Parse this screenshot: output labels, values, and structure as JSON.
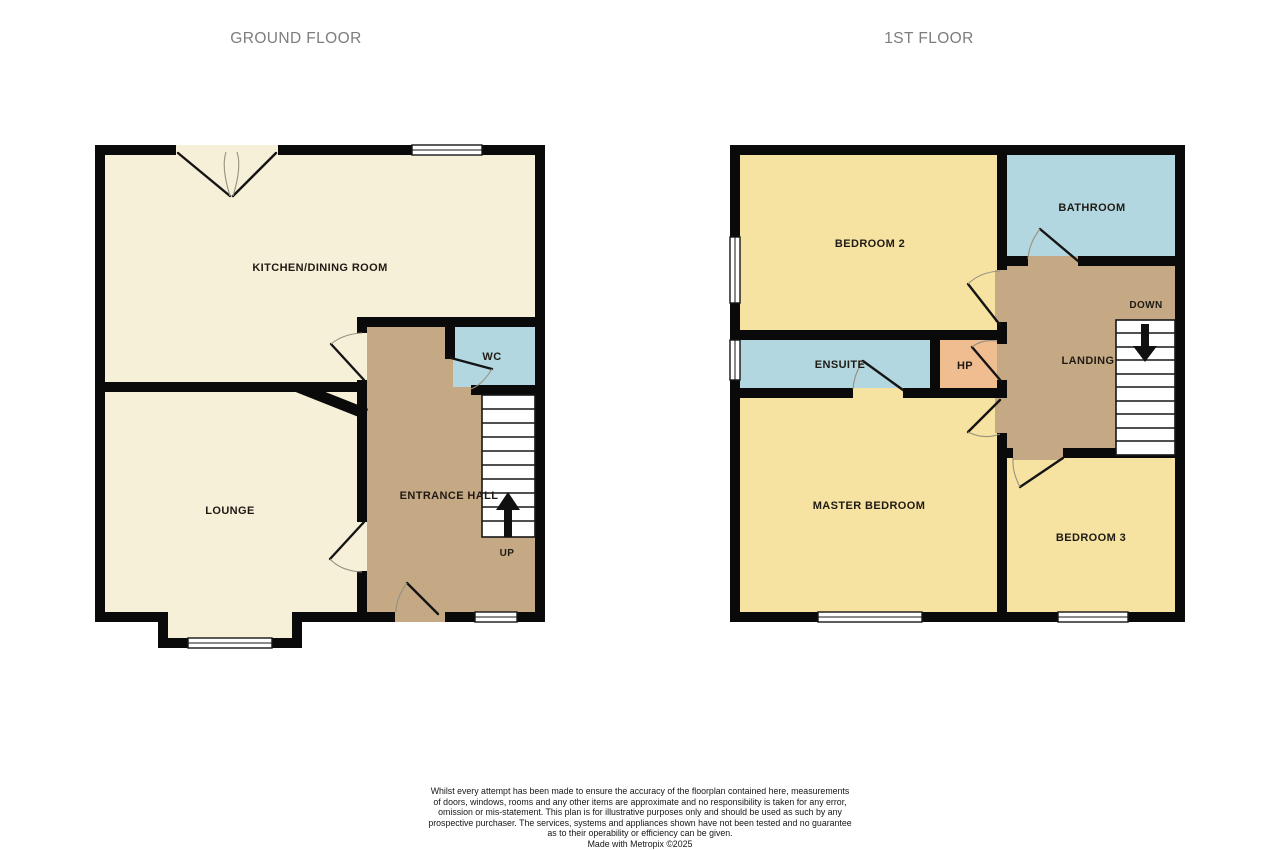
{
  "titles": {
    "ground": "GROUND FLOOR",
    "first": "1ST FLOOR"
  },
  "ground_floor": {
    "rooms": {
      "kitchen": "KITCHEN/DINING ROOM",
      "lounge": "LOUNGE",
      "entrance_hall": "ENTRANCE HALL",
      "wc": "WC"
    },
    "stairs_label": "UP"
  },
  "first_floor": {
    "rooms": {
      "bedroom2": "BEDROOM 2",
      "bathroom": "BATHROOM",
      "ensuite": "ENSUITE",
      "hp": "HP",
      "landing": "LANDING",
      "master_bedroom": "MASTER BEDROOM",
      "bedroom3": "BEDROOM 3"
    },
    "stairs_label": "DOWN"
  },
  "colors": {
    "floor_cream": "#F6F0D8",
    "floor_yellow": "#F6E3A1",
    "floor_blue": "#B3D7E0",
    "floor_tan": "#C5A984",
    "floor_orange": "#EFBD90",
    "wall": "#0A0A0A",
    "title_gray": "#7D7D7D",
    "label_dark": "#201A15"
  },
  "disclaimer": {
    "lines": [
      "Whilst every attempt has been made to ensure the accuracy of the floorplan contained here, measurements",
      "of doors, windows, rooms and any other items are approximate and no responsibility is taken for any error,",
      "omission or mis-statement. This plan is for illustrative purposes only and should be used as such by any",
      "prospective purchaser. The services, systems and appliances shown have not been tested and no guarantee",
      "as to their operability or efficiency can be given.",
      "Made with Metropix ©2025"
    ]
  }
}
